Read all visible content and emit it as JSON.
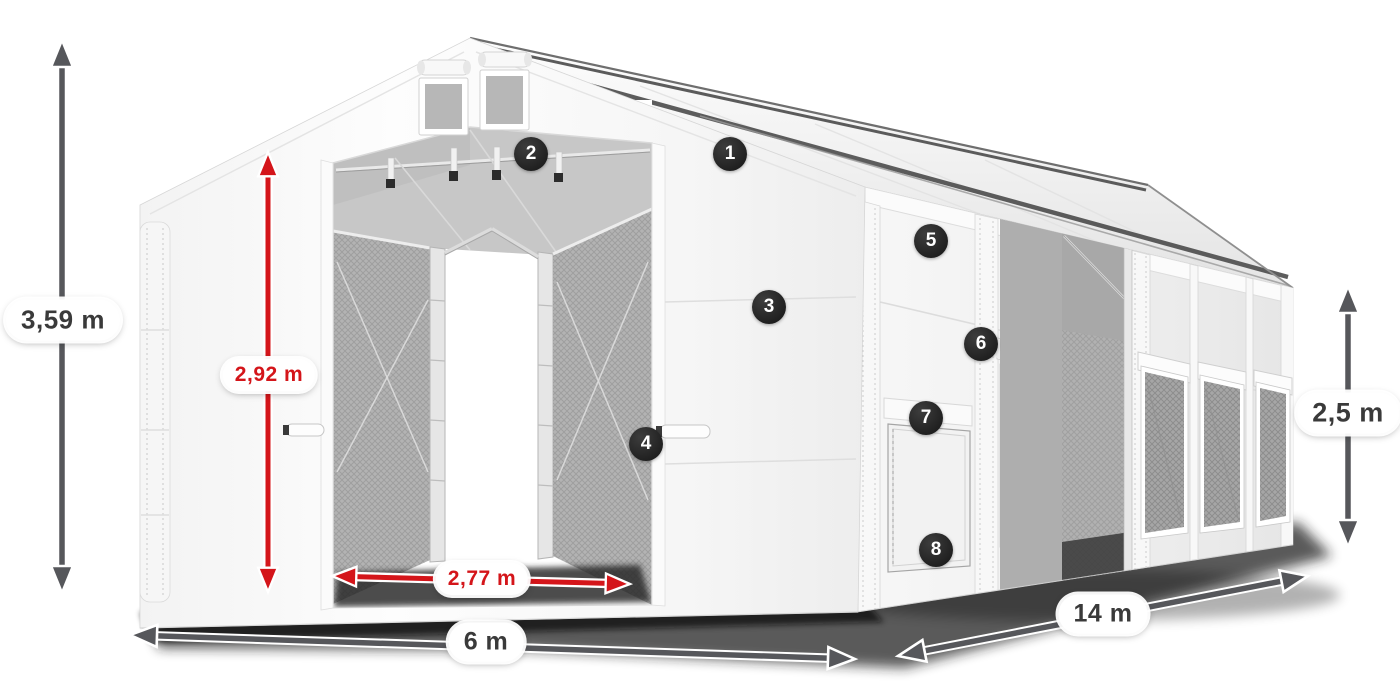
{
  "product_diagram": {
    "description_labels": {
      "total_height": "3,59 m",
      "door_height": "2,92 m",
      "door_width": "2,77 m",
      "front_width": "6 m",
      "length": "14 m",
      "side_wall_height": "2,5 m"
    },
    "feature_markers": [
      {
        "label": "1"
      },
      {
        "label": "2"
      },
      {
        "label": "3"
      },
      {
        "label": "4"
      },
      {
        "label": "5"
      },
      {
        "label": "6"
      },
      {
        "label": "7"
      },
      {
        "label": "8"
      }
    ],
    "colors": {
      "dimension_red": "#d4151a",
      "dimension_gray": "#56575b",
      "marker_background": "#2a2a2a",
      "marker_text": "#ffffff",
      "tent_white": "#f7f7f7",
      "mesh_gray": "#b3b3b3"
    }
  }
}
